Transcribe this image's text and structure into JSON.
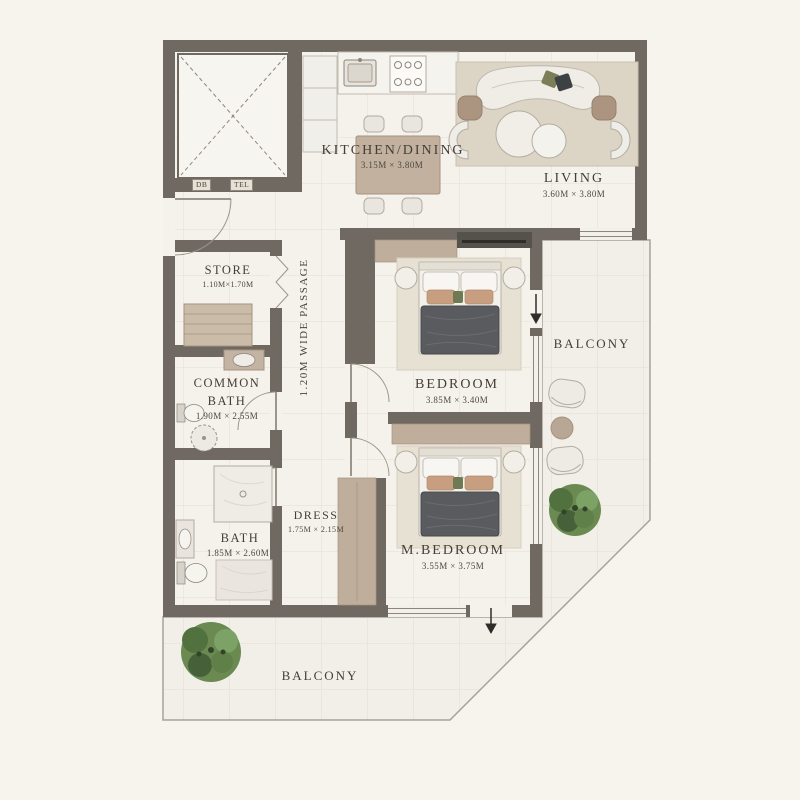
{
  "plan_title": "Apartment Floor Plan",
  "rooms": {
    "kitchen_dining": {
      "label": "KITCHEN/DINING",
      "dims": "3.15M × 3.80M"
    },
    "living": {
      "label": "LIVING",
      "dims": "3.60M × 3.80M"
    },
    "store": {
      "label": "STORE",
      "dims": "1.10M×1.70M"
    },
    "common_bath": {
      "line1": "COMMON",
      "line2": "BATH",
      "dims": "1.90M × 2.55M"
    },
    "bath": {
      "label": "BATH",
      "dims": "1.85M × 2.60M"
    },
    "dress": {
      "label": "DRESS",
      "dims": "1.75M × 2.15M"
    },
    "bedroom": {
      "label": "BEDROOM",
      "dims": "3.85M × 3.40M"
    },
    "master_bedroom": {
      "label": "M.BEDROOM",
      "dims": "3.55M × 3.75M"
    },
    "balcony_right": {
      "label": "BALCONY"
    },
    "balcony_bottom": {
      "label": "BALCONY"
    },
    "passage": {
      "label": "1.20M WIDE PASSAGE"
    },
    "utilities": {
      "db": "DB",
      "tel": "TEL"
    }
  },
  "colors": {
    "background": "#f7f3ed",
    "wall": "#6f6962",
    "floor": "#f5f2ec",
    "balcony_floor": "#f2efe8",
    "grid_line": "#e3ddd0",
    "accent_tan": "#bfae9c",
    "bed_duvet": "#595b5f",
    "plant_green": "#5f7d4b",
    "text": "#443e37"
  }
}
